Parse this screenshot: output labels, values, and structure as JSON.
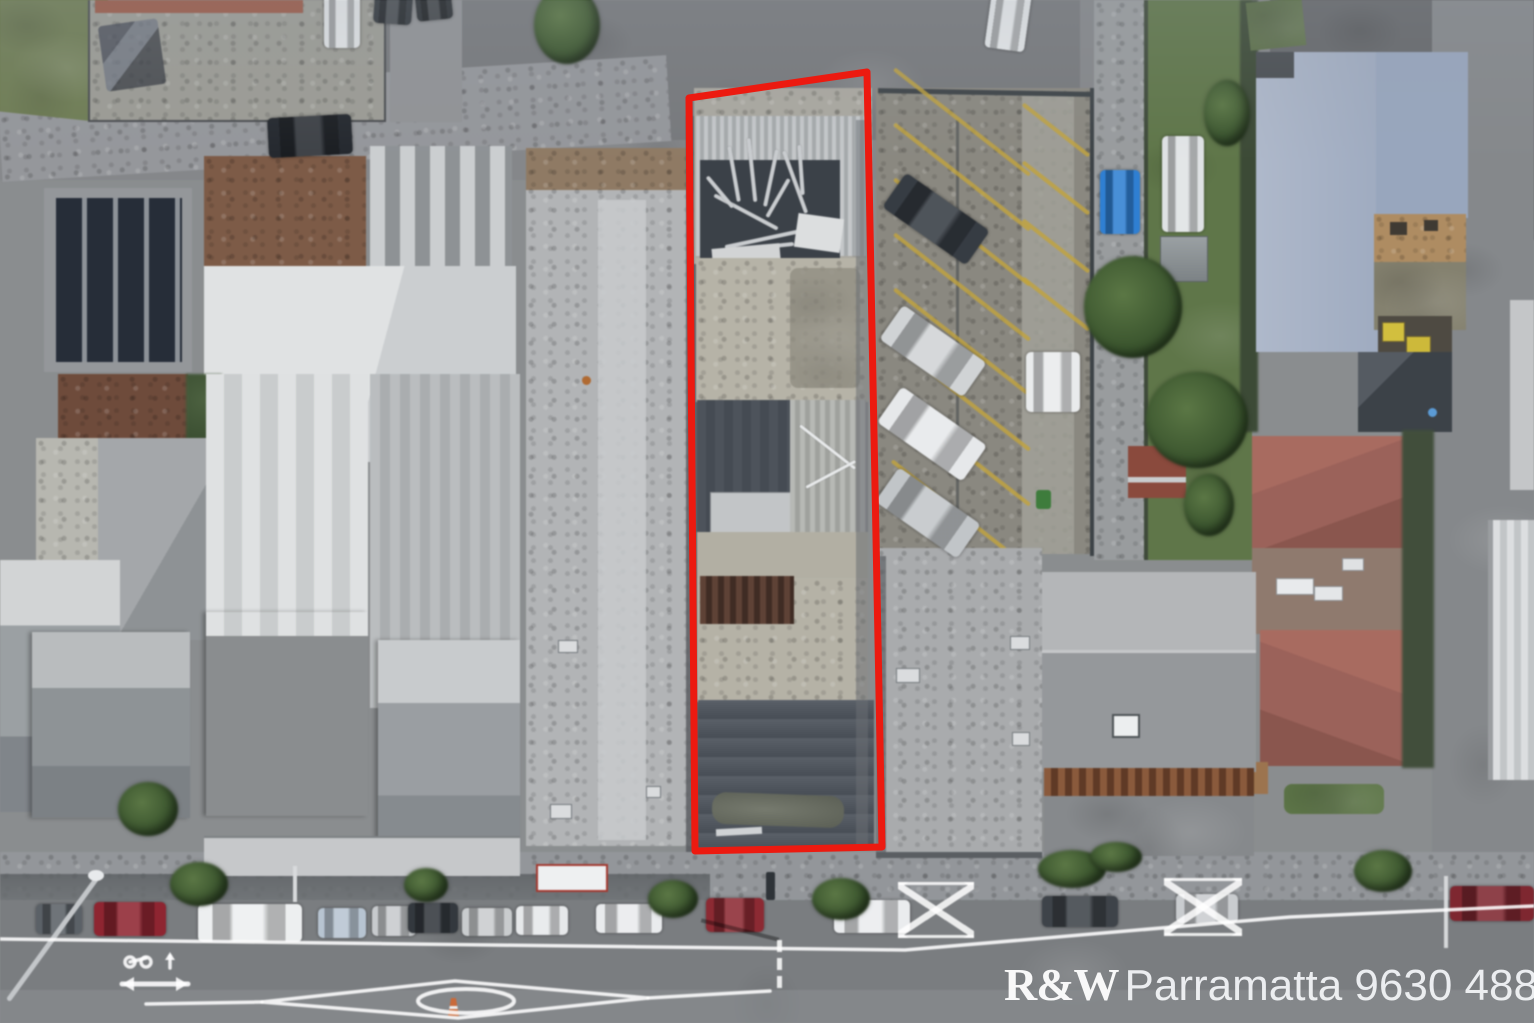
{
  "watermark": {
    "brand": "R&W",
    "location_phone": "Parramatta 9630 4888",
    "color": "#ffffff"
  },
  "boundary": {
    "color": "#ec1a10",
    "stroke_width": 7,
    "points": "689,98 867,72 882,847 695,851"
  },
  "palette": {
    "road_top": "#7c7f82",
    "road_bottom": "#7a7d80",
    "footpath": "#93969a",
    "grass": "#5f7649",
    "parking_asphalt": "#8a8880",
    "parking_line_yellow": "#c2a43c",
    "blue_roof": "#a5b0c5",
    "red_hip_roof": "#9b625a",
    "dark_roof": "#4d535b",
    "white_roof": "#d9dbdc",
    "concrete_yard": "#b5b2a6",
    "solar_panel": "#262d38",
    "rust_roof": "#7d5b47",
    "brown_corrugated": "#5e4236",
    "blue_car": "#2f7fd2"
  },
  "street_cars": [
    {
      "x": 36,
      "y": 904,
      "w": 46,
      "h": 30,
      "c": "#5b6167"
    },
    {
      "x": 94,
      "y": 902,
      "w": 72,
      "h": 34,
      "c": "#8e2531"
    },
    {
      "x": 198,
      "y": 904,
      "w": 104,
      "h": 38,
      "c": "#edeff0"
    },
    {
      "x": 318,
      "y": 908,
      "w": 48,
      "h": 30,
      "c": "#b7c4d1"
    },
    {
      "x": 372,
      "y": 906,
      "w": 44,
      "h": 30,
      "c": "#c7cacd"
    },
    {
      "x": 408,
      "y": 903,
      "w": 50,
      "h": 30,
      "c": "#33383e"
    },
    {
      "x": 462,
      "y": 908,
      "w": 50,
      "h": 28,
      "c": "#c9ccce"
    },
    {
      "x": 516,
      "y": 906,
      "w": 52,
      "h": 29,
      "c": "#e6e8ea"
    },
    {
      "x": 596,
      "y": 904,
      "w": 66,
      "h": 29,
      "c": "#e9ebed"
    },
    {
      "x": 706,
      "y": 898,
      "w": 58,
      "h": 34,
      "c": "#8c2a33"
    },
    {
      "x": 834,
      "y": 900,
      "w": 76,
      "h": 33,
      "c": "#eaecee"
    },
    {
      "x": 1042,
      "y": 896,
      "w": 76,
      "h": 31,
      "c": "#3e4349"
    },
    {
      "x": 1176,
      "y": 894,
      "w": 62,
      "h": 29,
      "c": "#c9cccf"
    },
    {
      "x": 1450,
      "y": 886,
      "w": 84,
      "h": 35,
      "c": "#7e2730"
    }
  ],
  "parking_cars": [
    {
      "x": 885,
      "y": 198,
      "w": 102,
      "h": 42,
      "c": "#363c43",
      "r": 35
    },
    {
      "x": 882,
      "y": 330,
      "w": 102,
      "h": 42,
      "c": "#d0d3d5",
      "r": 35
    },
    {
      "x": 880,
      "y": 412,
      "w": 104,
      "h": 44,
      "c": "#e6e8ea",
      "r": 35
    },
    {
      "x": 878,
      "y": 492,
      "w": 100,
      "h": 42,
      "c": "#c1c5c8",
      "r": 35
    },
    {
      "x": 1026,
      "y": 352,
      "w": 54,
      "h": 60,
      "c": "#e9ebec",
      "r": 0
    },
    {
      "x": 988,
      "y": -8,
      "w": 40,
      "h": 58,
      "c": "#e2e5e7",
      "r": 8
    },
    {
      "x": 1100,
      "y": 170,
      "w": 40,
      "h": 64,
      "c": "#2f7fd2",
      "r": 0
    },
    {
      "x": 1162,
      "y": 136,
      "w": 42,
      "h": 96,
      "c": "#dfe2e4",
      "r": 0
    },
    {
      "x": 268,
      "y": 116,
      "w": 84,
      "h": 40,
      "c": "#24282e",
      "r": -3
    },
    {
      "x": 324,
      "y": -10,
      "w": 36,
      "h": 58,
      "c": "#dfe2e4",
      "r": 0
    },
    {
      "x": 374,
      "y": -6,
      "w": 38,
      "h": 30,
      "c": "#33383d",
      "r": 4
    },
    {
      "x": 416,
      "y": -8,
      "w": 36,
      "h": 28,
      "c": "#2c3034",
      "r": -6
    }
  ],
  "parking_lines": [
    {
      "x": 876,
      "y": 120,
      "w": 172,
      "r": 38
    },
    {
      "x": 876,
      "y": 175,
      "w": 172,
      "r": 38
    },
    {
      "x": 876,
      "y": 230,
      "w": 172,
      "r": 38
    },
    {
      "x": 876,
      "y": 285,
      "w": 172,
      "r": 38
    },
    {
      "x": 876,
      "y": 340,
      "w": 172,
      "r": 38
    },
    {
      "x": 876,
      "y": 395,
      "w": 172,
      "r": 38
    },
    {
      "x": 876,
      "y": 450,
      "w": 172,
      "r": 38
    },
    {
      "x": 876,
      "y": 505,
      "w": 150,
      "r": 38
    },
    {
      "x": 1014,
      "y": 128,
      "w": 84,
      "r": 38
    },
    {
      "x": 1014,
      "y": 186,
      "w": 84,
      "r": 38
    },
    {
      "x": 1014,
      "y": 244,
      "w": 84,
      "r": 38
    },
    {
      "x": 1014,
      "y": 302,
      "w": 84,
      "r": 38
    }
  ],
  "trees": [
    {
      "x": 170,
      "y": 862,
      "w": 58,
      "h": 44
    },
    {
      "x": 404,
      "y": 868,
      "w": 44,
      "h": 34
    },
    {
      "x": 648,
      "y": 880,
      "w": 50,
      "h": 38
    },
    {
      "x": 812,
      "y": 878,
      "w": 58,
      "h": 42
    },
    {
      "x": 1038,
      "y": 850,
      "w": 68,
      "h": 38
    },
    {
      "x": 1354,
      "y": 850,
      "w": 58,
      "h": 42
    },
    {
      "x": 534,
      "y": -14,
      "w": 66,
      "h": 78
    },
    {
      "x": 1084,
      "y": 256,
      "w": 98,
      "h": 102
    },
    {
      "x": 1146,
      "y": 372,
      "w": 102,
      "h": 96
    },
    {
      "x": 1204,
      "y": 80,
      "w": 46,
      "h": 66
    },
    {
      "x": 1184,
      "y": 474,
      "w": 50,
      "h": 62
    },
    {
      "x": 118,
      "y": 782,
      "w": 60,
      "h": 54
    },
    {
      "x": 1090,
      "y": 842,
      "w": 52,
      "h": 30
    }
  ],
  "pedestrian_fences": [
    {
      "x": 898,
      "y": 882,
      "w": 76,
      "h": 50
    },
    {
      "x": 1164,
      "y": 878,
      "w": 78,
      "h": 52
    }
  ],
  "debris_sticks": [
    {
      "x": 706,
      "y": 172,
      "w": 56,
      "r": 80
    },
    {
      "x": 720,
      "y": 168,
      "w": 64,
      "r": 84
    },
    {
      "x": 742,
      "y": 176,
      "w": 58,
      "r": -78
    },
    {
      "x": 762,
      "y": 180,
      "w": 66,
      "r": 70
    },
    {
      "x": 710,
      "y": 210,
      "w": 72,
      "r": 28
    },
    {
      "x": 724,
      "y": 236,
      "w": 88,
      "r": -12
    },
    {
      "x": 716,
      "y": 246,
      "w": 78,
      "r": -6
    },
    {
      "x": 756,
      "y": 196,
      "w": 44,
      "r": -60
    },
    {
      "x": 776,
      "y": 168,
      "w": 50,
      "r": 86
    },
    {
      "x": 700,
      "y": 190,
      "w": 40,
      "r": 50
    }
  ],
  "road_dashes": [
    {
      "x": 777,
      "y": 940
    },
    {
      "x": 777,
      "y": 958
    },
    {
      "x": 777,
      "y": 976
    }
  ]
}
